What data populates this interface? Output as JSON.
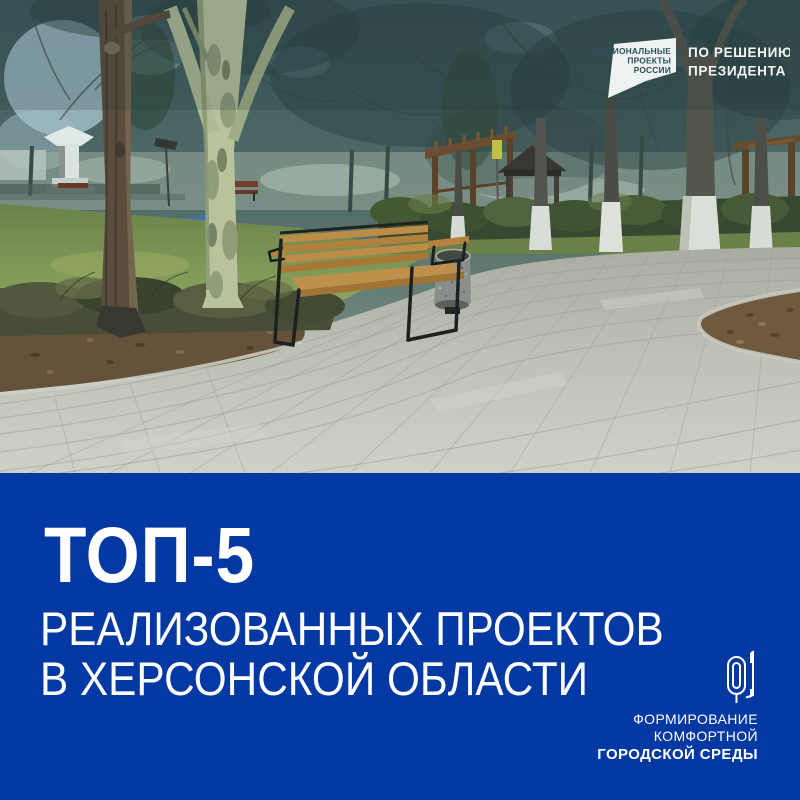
{
  "photo": {
    "description": "Park square: wooden bench with black metal frame and stone litter bin on fresh grey paving, curved planting beds, green lawn, bare trees with whitewashed trunks, white monument, wooden pergolas and a timber playground tower"
  },
  "national_projects_logo": {
    "flag_line1": "НАЦИОНАЛЬНЫЕ",
    "flag_line2": "ПРОЕКТЫ",
    "flag_line3": "РОССИИ",
    "tagline_line1": "ПО РЕШЕНИЮ",
    "tagline_line2": "ПРЕЗИДЕНТА"
  },
  "banner": {
    "title": "ТОП-5",
    "subtitle_line1": "РЕАЛИЗОВАННЫХ ПРОЕКТОВ",
    "subtitle_line2": "В ХЕРСОНСКОЙ ОБЛАСТИ"
  },
  "fkgs_logo": {
    "line1": "ФОРМИРОВАНИЕ",
    "line2": "КОМФОРТНОЙ",
    "line3": "ГОРОДСКОЙ СРЕДЫ"
  },
  "colors": {
    "panel_blue": "#0438a3",
    "text_white": "#ffffff",
    "flag_white": "#eef3f2",
    "flag_text": "#2b4f5e",
    "bench_wood": "#c98f44",
    "pavement": "#cdc9bf",
    "grass": "#7d9150",
    "soil": "#6b4f35"
  }
}
